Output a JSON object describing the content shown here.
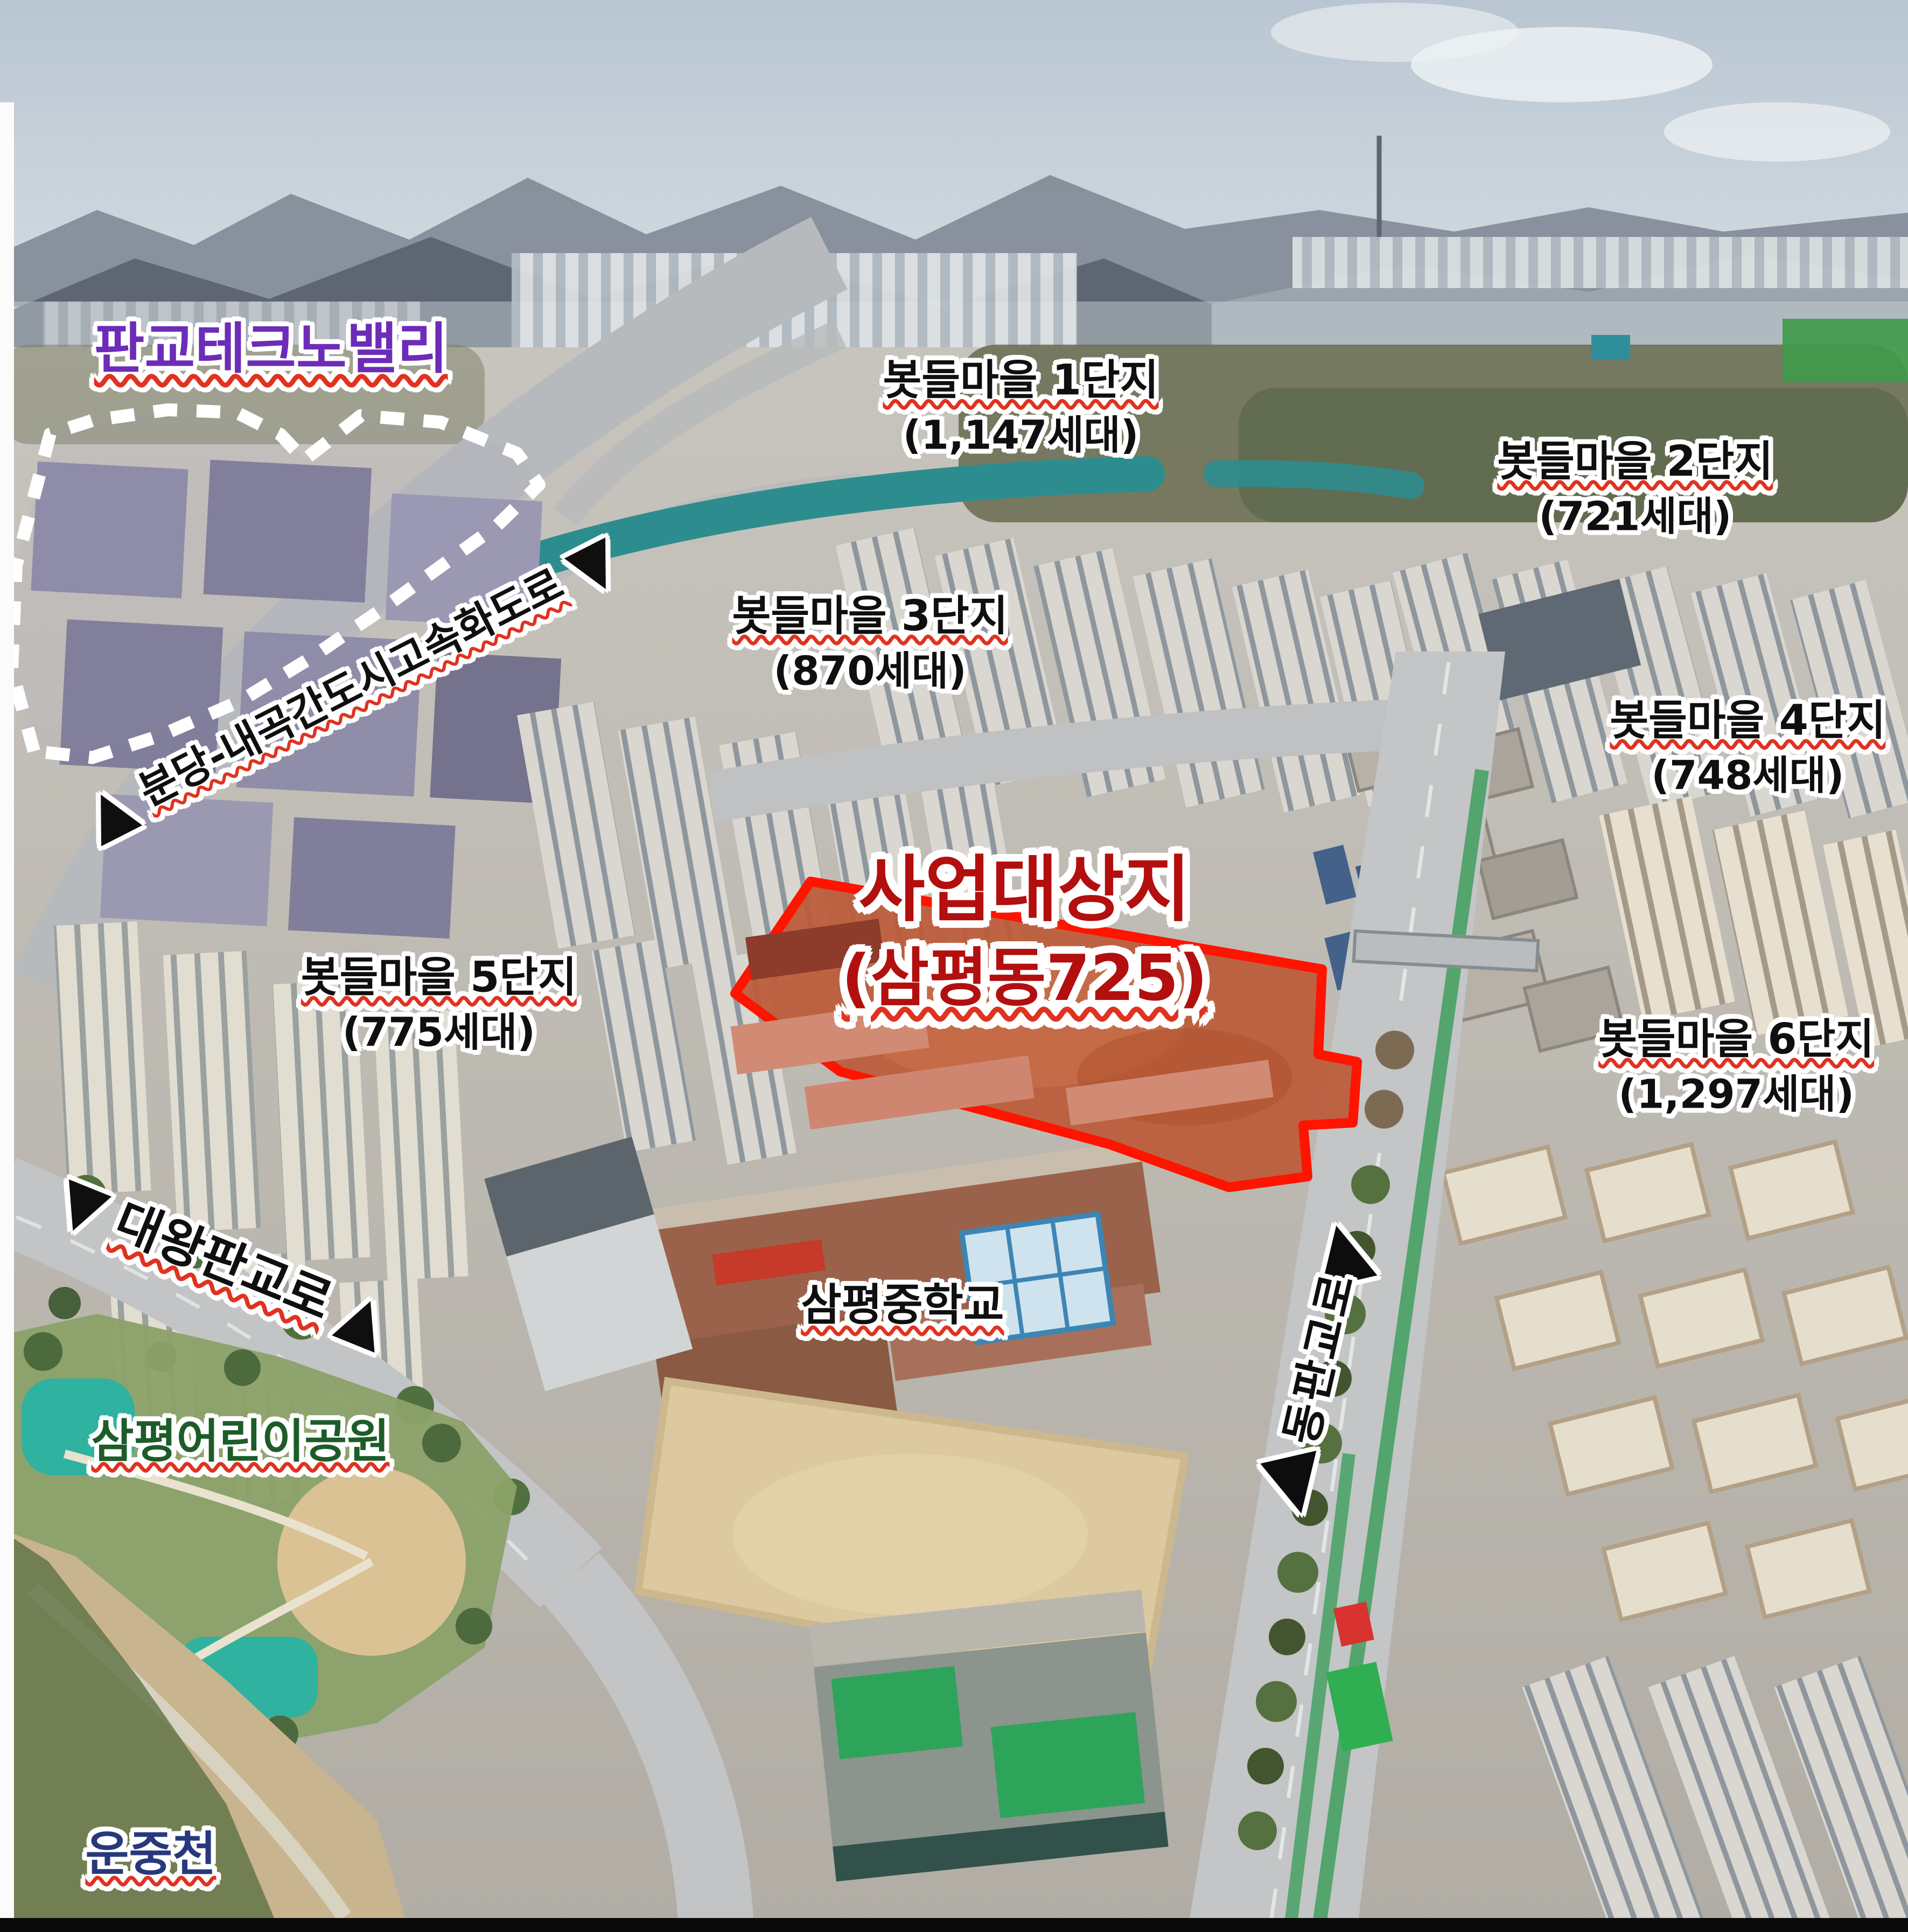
{
  "labels": {
    "techno_valley": {
      "text": "판교테크노밸리",
      "color": "#6d2cb8"
    },
    "complexes": {
      "c1": {
        "name": "봇들마을 1단지",
        "households": "(1,147세대)"
      },
      "c2": {
        "name": "봇들마을 2단지",
        "households": "(721세대)"
      },
      "c3": {
        "name": "봇들마을 3단지",
        "households": "(870세대)"
      },
      "c4": {
        "name": "봇들마을 4단지",
        "households": "(748세대)"
      },
      "c5": {
        "name": "봇들마을 5단지",
        "households": "(775세대)"
      },
      "c6": {
        "name": "봇들마을 6단지",
        "households": "(1,297세대)"
      }
    },
    "site": {
      "title": "사업대상지",
      "address": "(삼평동725)",
      "color": "#b20f0e",
      "outline_color": "#ff1400",
      "fill_color": "#bc5a38"
    },
    "roads": {
      "bundang_naegok": {
        "name": "분당-내곡간도시고속화도로",
        "arrow_start": "▲",
        "arrow_end": "▼"
      },
      "daewang_pangyo": {
        "name": "대왕판교로",
        "arrow_start": "▼",
        "arrow_end": "▲"
      },
      "dong_pangyo": {
        "name": "동판교로",
        "arrow_top": "▲",
        "arrow_bottom": "▼"
      }
    },
    "places": {
      "school": {
        "name": "삼평중학교",
        "color": "#111111"
      },
      "park": {
        "name": "삼평어린이공원",
        "color": "#1d5c28"
      },
      "stream": {
        "name": "운중천",
        "color": "#27397c"
      }
    },
    "underline_color": "#e03220"
  },
  "boundary": {
    "style": "white-dotted",
    "color": "#ffffff"
  }
}
